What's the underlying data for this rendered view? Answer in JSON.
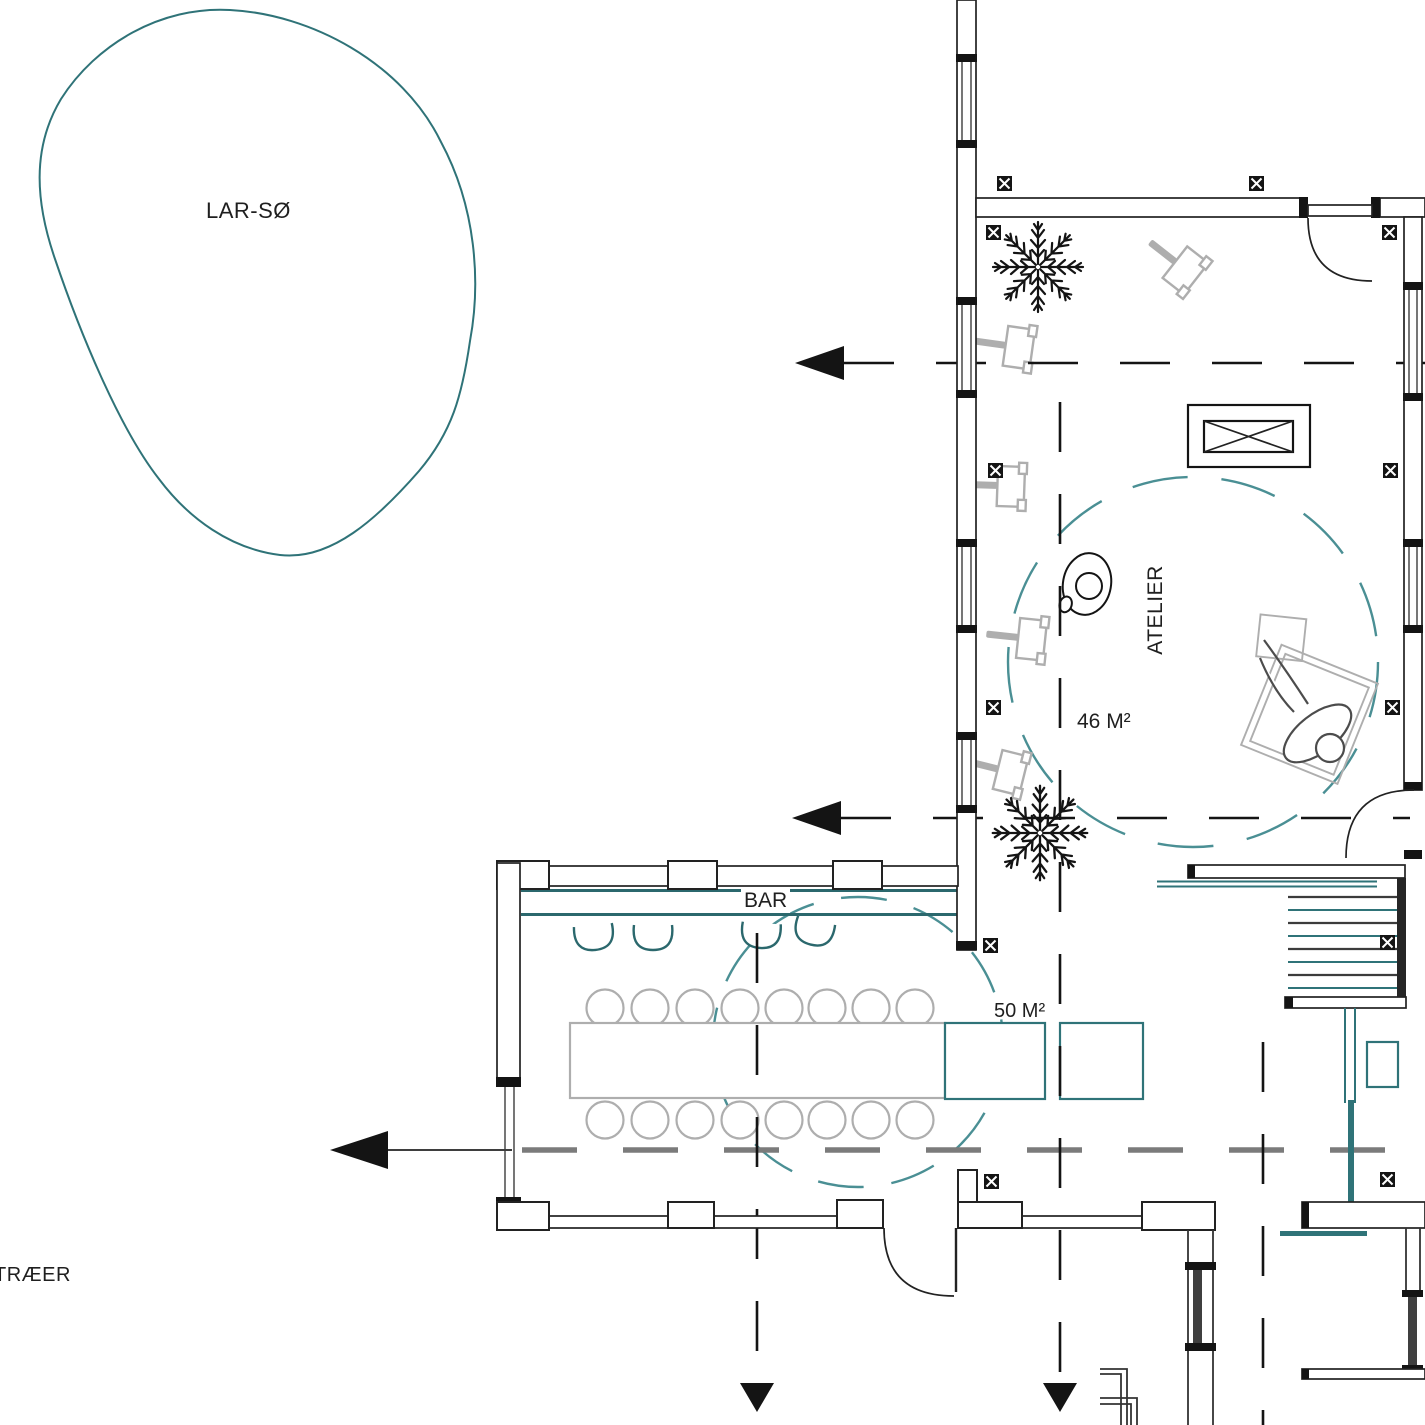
{
  "drawing": {
    "type": "architectural-floor-plan",
    "labels": {
      "lake": "LAR-SØ",
      "atelier_room": "ATELIER",
      "atelier_area": "46 M²",
      "bar_room": "BAR",
      "bar_area": "50 M²",
      "trees": "TRÆER"
    },
    "rooms": [
      {
        "name": "ATELIER",
        "area_m2": 46
      },
      {
        "name": "BAR",
        "area_m2": 50
      }
    ],
    "icons": {
      "column-marker-icon": "black square with white diagonal X",
      "plant-icon": "conifer top-view star",
      "easel-icon": "painter easel top-view",
      "stool-icon": "bar stool half-round seat",
      "chair-icon": "round chair",
      "section-arrow-icon": "solid black triangle on dashed section line",
      "door-swing-icon": "quarter-circle arc",
      "stairs-icon": "parallel treads",
      "skylight-icon": "rectangle with X"
    },
    "colors": {
      "wall": "#222222",
      "ink": "#141414",
      "teal": "#2f7378",
      "tealLight": "#4a8f94",
      "tealDark": "#2b686d",
      "furnGray": "#aeaeae",
      "figGray": "#4c4c4c",
      "dashGray": "#7b7b7b"
    }
  }
}
